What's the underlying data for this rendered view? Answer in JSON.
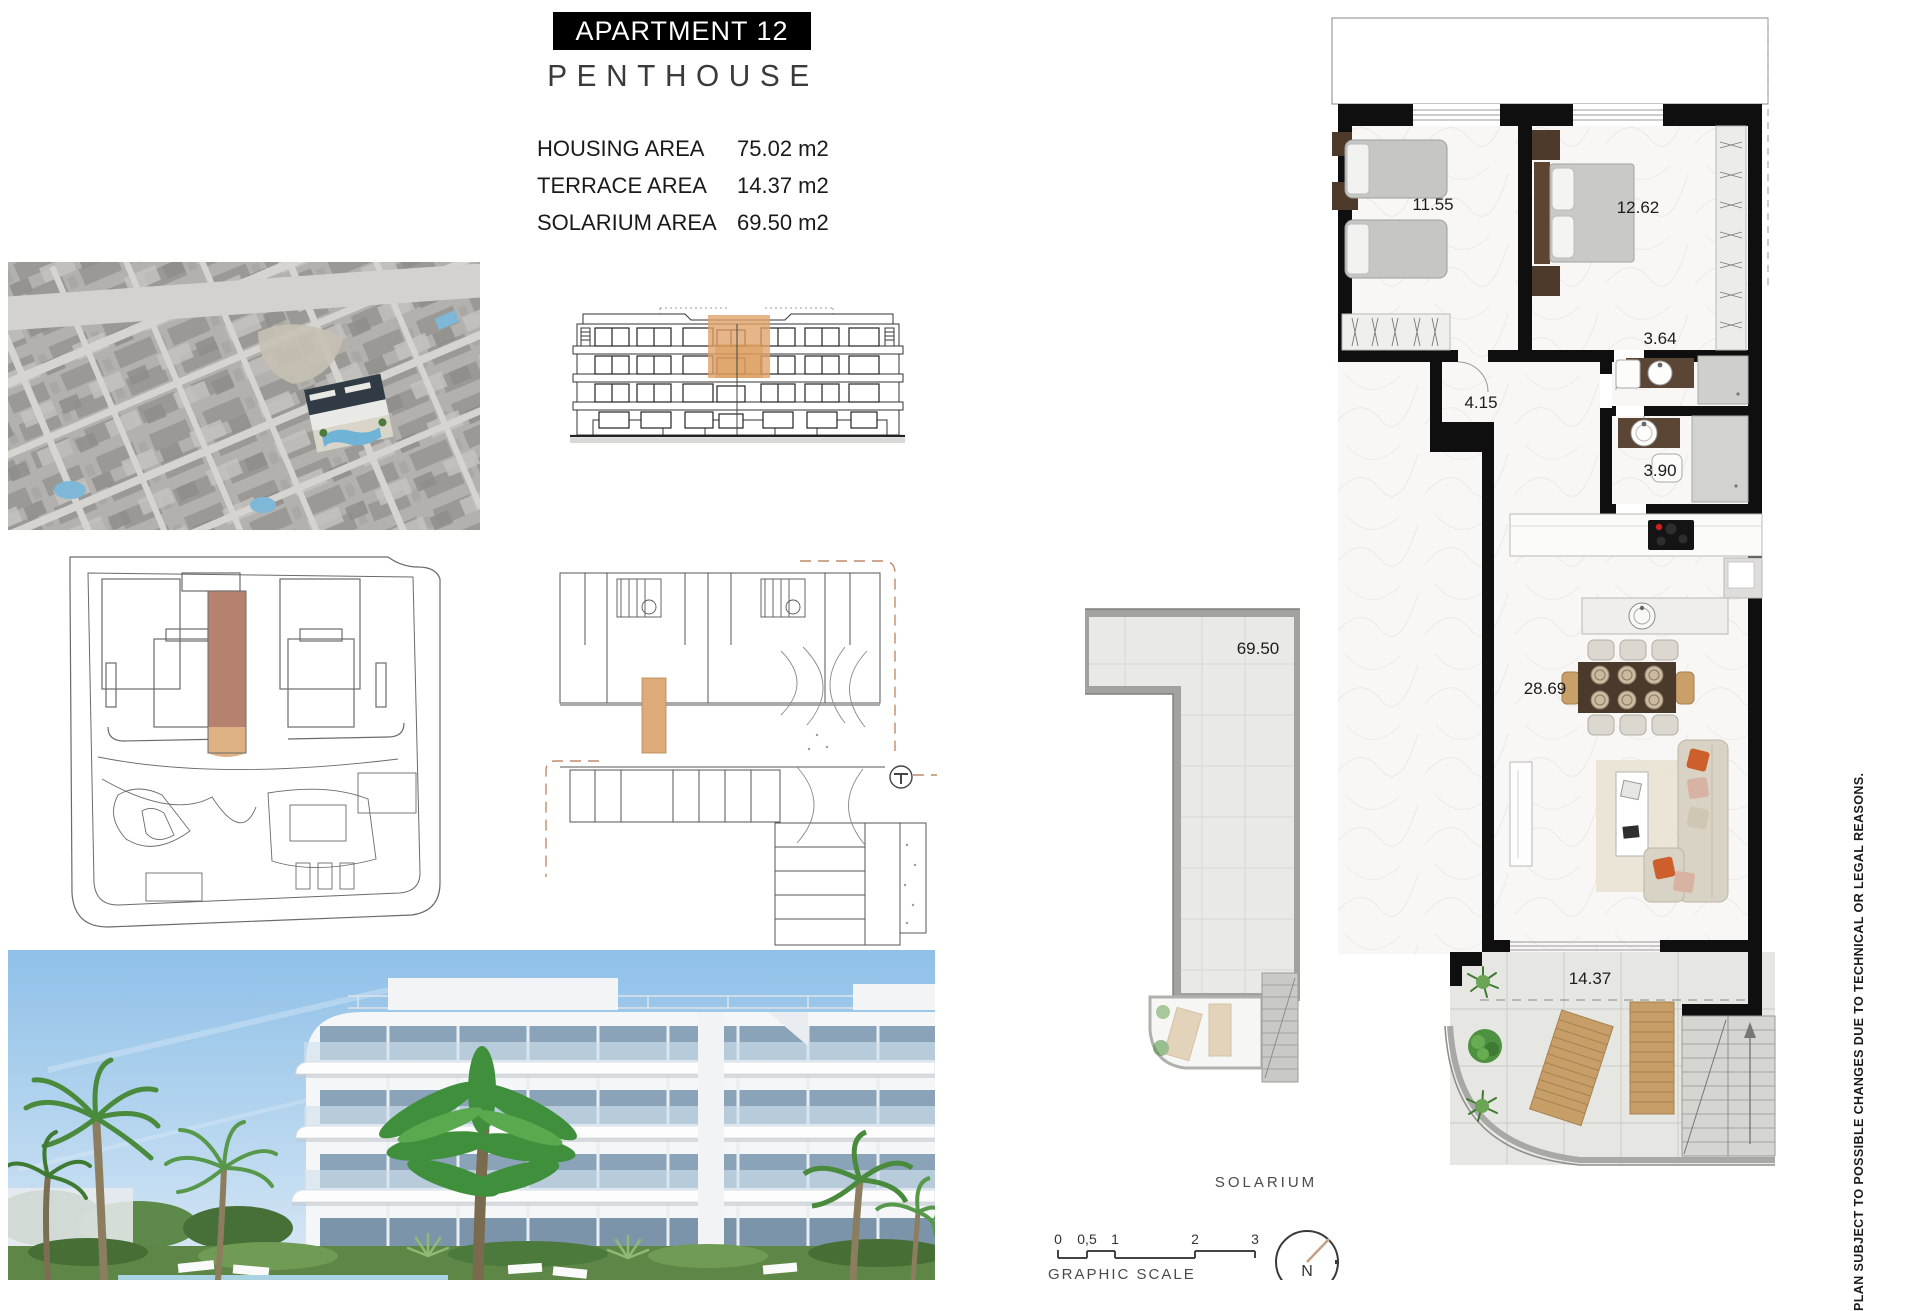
{
  "title": {
    "apartment": "APARTMENT 12",
    "type": "PENTHOUSE"
  },
  "areas": [
    {
      "label": "HOUSING AREA",
      "value": "75.02 m2"
    },
    {
      "label": "TERRACE AREA",
      "value": "14.37 m2"
    },
    {
      "label": "SOLARIUM AREA",
      "value": "69.50 m2"
    }
  ],
  "floorplan": {
    "rooms": [
      {
        "name": "twin-bedroom",
        "area": "11.55"
      },
      {
        "name": "master-bedroom",
        "area": "12.62"
      },
      {
        "name": "bathroom-1",
        "area": "3.64"
      },
      {
        "name": "hallway",
        "area": "4.15"
      },
      {
        "name": "bathroom-2",
        "area": "3.90"
      },
      {
        "name": "living-dining",
        "area": "28.69"
      },
      {
        "name": "terrace",
        "area": "14.37"
      }
    ]
  },
  "solarium": {
    "area": "69.50",
    "label": "SOLARIUM"
  },
  "scale": {
    "ticks": [
      "0",
      "0,5",
      "1",
      "2",
      "3"
    ],
    "label": "GRAPHIC SCALE"
  },
  "north": {
    "label": "N"
  },
  "disclaimer": "PLAN SUBJECT TO POSSIBLE CHANGES DUE TO TECHNICAL OR LEGAL REASONS.",
  "colors": {
    "highlight_orange": "#e0a267",
    "highlight_brown": "#b5826f",
    "wall": "#0f0f0f"
  }
}
